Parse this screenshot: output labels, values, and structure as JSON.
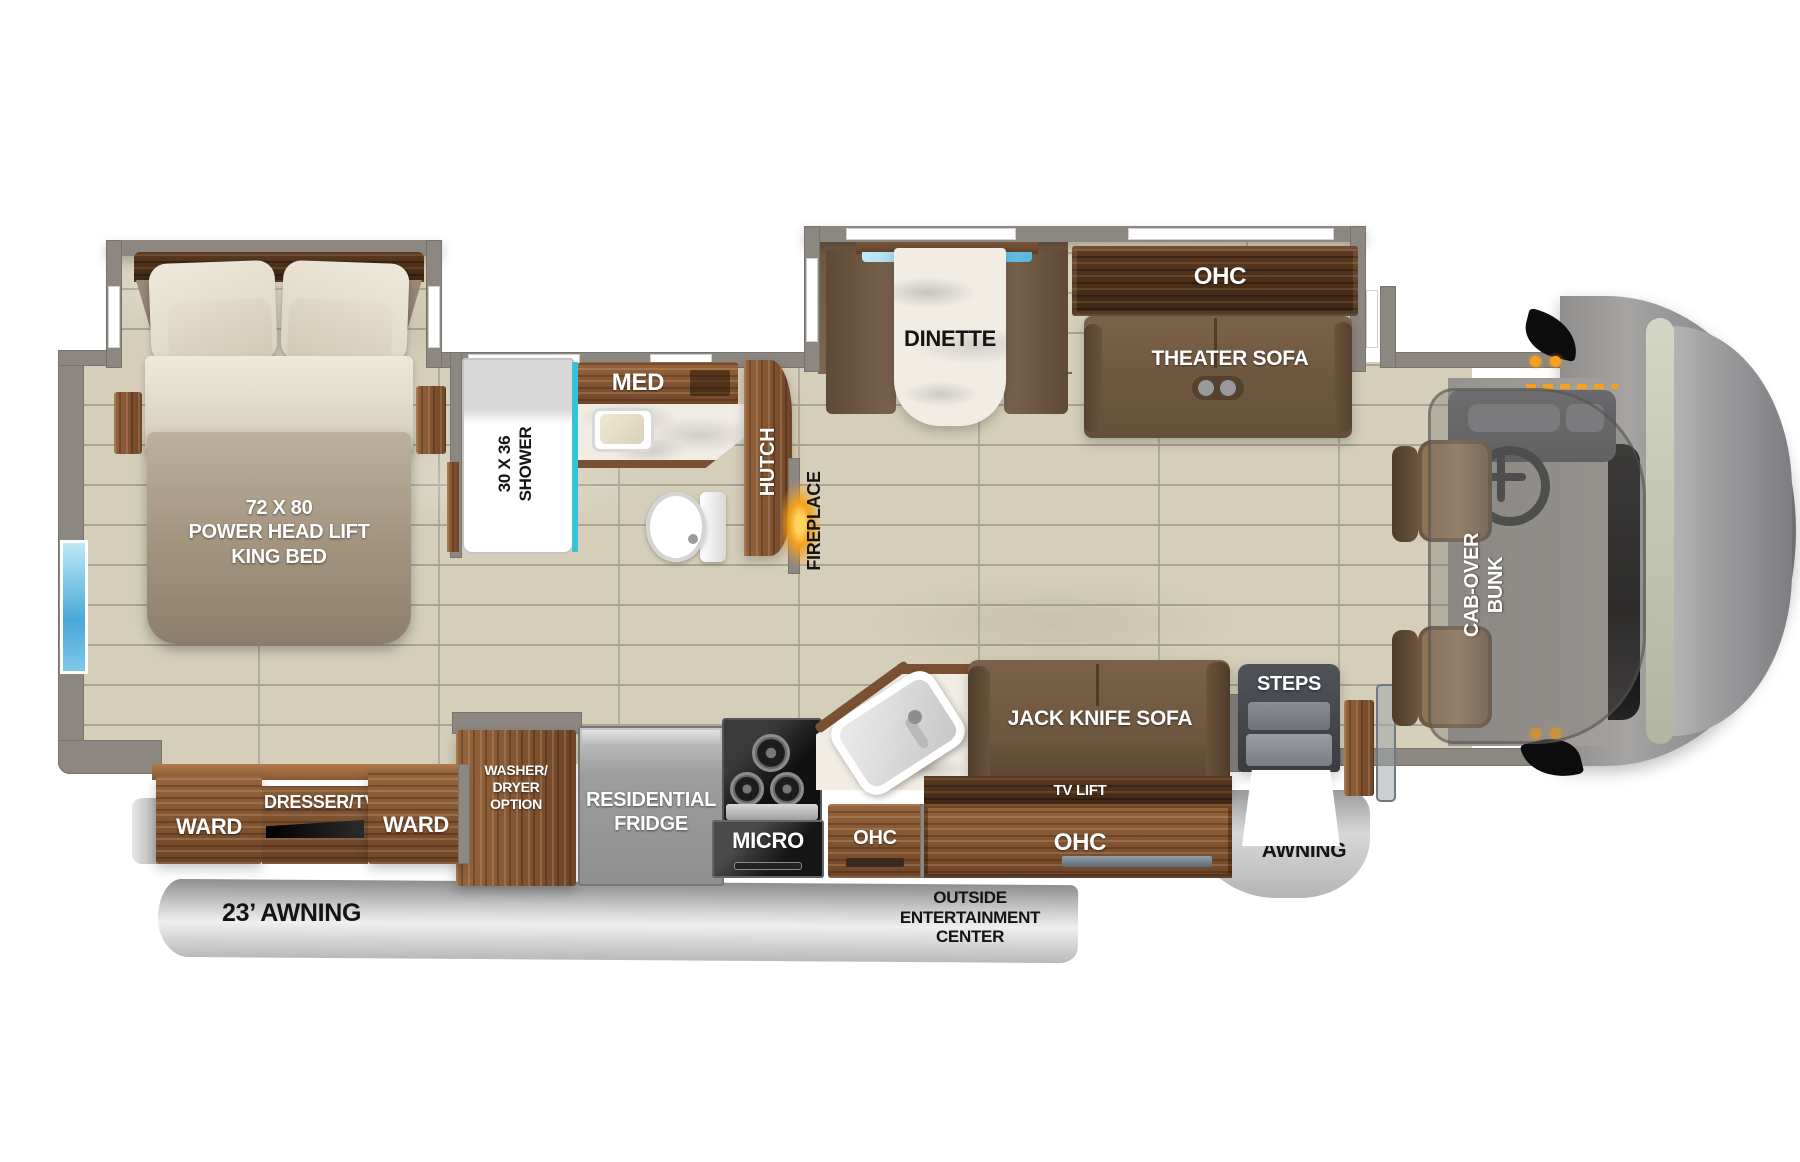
{
  "plan": {
    "bedroom": {
      "bed": "72 X 80\nPOWER HEAD LIFT\nKING BED",
      "ward_left": "WARD",
      "dresser_tv": "DRESSER/TV",
      "ward_right": "WARD"
    },
    "bath": {
      "shower": "30 X 36\nSHOWER",
      "med": "MED",
      "hutch": "HUTCH",
      "fireplace": "FIREPLACE"
    },
    "galley": {
      "washer_dryer": "WASHER/\nDRYER\nOPTION",
      "fridge": "RESIDENTIAL\nFRIDGE",
      "micro": "MICRO",
      "ohc": "OHC"
    },
    "living": {
      "dinette": "DINETTE",
      "theater_ohc": "OHC",
      "theater_sofa": "THEATER SOFA",
      "jack_knife_sofa": "JACK KNIFE SOFA",
      "tv_lift": "TV LIFT",
      "sofa_ohc": "OHC"
    },
    "cab": {
      "bunk": "CAB-OVER\nBUNK",
      "steps": "STEPS"
    },
    "exterior": {
      "main_awning": "23’ AWNING",
      "entertainment": "OUTSIDE\nENTERTAINMENT\nCENTER",
      "door_awning": "DOOR\nAWNING"
    }
  },
  "colors": {
    "wall": "#8d8781",
    "floor": "#d5cfb9",
    "wood": "#7e5131",
    "dark_wood": "#4a2e1a",
    "sofa": "#6f5840",
    "marble": "#f1ede4",
    "shower_glass": "#35c4d7",
    "fireplace_glow": "#ffaa2b",
    "awning": "#c9c9c9",
    "window": "#7ec8ea"
  }
}
